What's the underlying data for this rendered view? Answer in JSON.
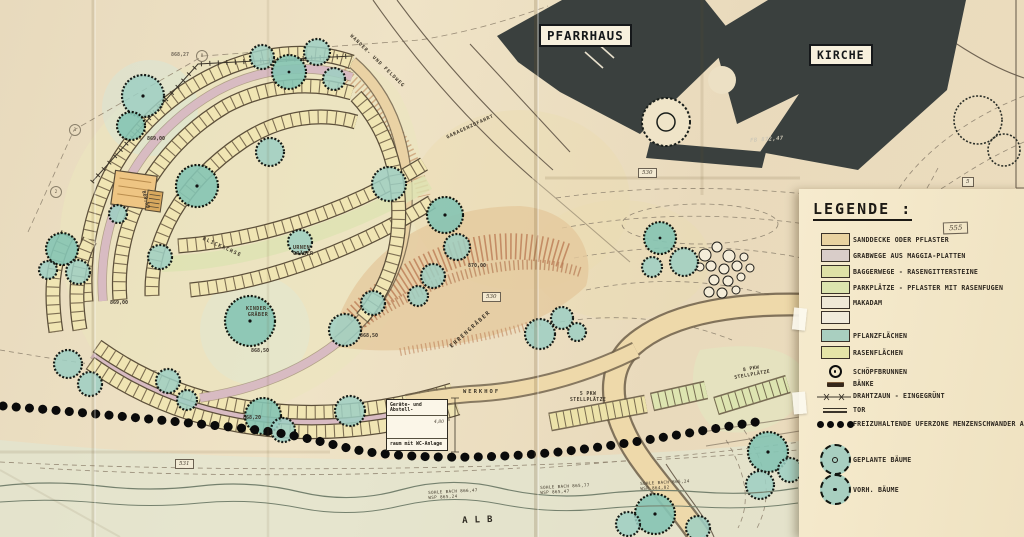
{
  "map": {
    "buildings": {
      "pfarrhaus": "PFARRHAUS",
      "kirche": "KIRCHE",
      "kirche_floor_elevation": "FB 872,47"
    },
    "roads": {
      "wanderweg": "WANDER- UND FELDWEG",
      "garagenzufahrt": "GARAGENZUFAHRT"
    },
    "areas": {
      "blickachse": "BLICKACHSE",
      "urnengraeber_l1": "URNEN-",
      "urnengraeber_l2": "GRÄBER",
      "kindergraeber_l1": "KINDER-",
      "kindergraeber_l2": "GRÄBER",
      "ehrengraeber": "EHRENGRÄBER",
      "werkhof": "WERKHOF",
      "stellplaetze5_l1": "5 PKW",
      "stellplaetze5_l2": "STELLPLÄTZE",
      "stellplaetze8_l1": "8 PKW",
      "stellplaetze8_l2": "STELLPLÄTZE"
    },
    "shed": {
      "line1": "Geräte- und Abstell-",
      "line2": "raum mit WC-Anlage",
      "dim": "4,80"
    },
    "parcels": {
      "p530a": "530",
      "p530b": "530",
      "p531": "531",
      "p5": "5"
    },
    "markers": {
      "m1": "1",
      "m2": "2",
      "m8": "8"
    },
    "elevations": {
      "e1": "869,00",
      "e2": "869,00",
      "e3": "868,50",
      "e4": "868,50",
      "e5": "870,00",
      "e6": "868,20",
      "e7": "868,27",
      "e8": "869,50"
    },
    "river": {
      "name": "ALB",
      "g1": {
        "sohle": "SOHLE BACH",
        "sohle_e": "866,47",
        "wsp": "WSP",
        "wsp_e": "865,24"
      },
      "g2": {
        "sohle": "SOHLE BACH",
        "sohle_e": "865,77",
        "wsp": "WSP",
        "wsp_e": "865,47"
      },
      "g3": {
        "sohle": "SOHLE BACH",
        "sohle_e": "865,24",
        "wsp": "WSP",
        "wsp_e": "864,82"
      }
    }
  },
  "legend": {
    "title": "LEGENDE :",
    "sheet_no": "555",
    "items": [
      {
        "label": "SANDDECKE ODER PFLASTER",
        "color": "#e9d2a0"
      },
      {
        "label": "GRABWEGE AUS MAGGIA-PLATTEN",
        "color": "#d9cdc9"
      },
      {
        "label": "BAGGERWEGE - RASENGITTERSTEINE",
        "color": "#dfe1a6"
      },
      {
        "label": "PARKPLÄTZE - PFLASTER MIT RASENFUGEN",
        "color": "#dce4ae"
      },
      {
        "label": "MAKADAM",
        "color": "#efe8d6"
      },
      {
        "label": "",
        "color": "#f1ebdb"
      },
      {
        "label": "PFLANZFLÄCHEN",
        "color": "#a9cfc0"
      },
      {
        "label": "RASENFLÄCHEN",
        "color": "#e5e4a7"
      }
    ],
    "symbols": [
      {
        "label": "SCHÖPFBRUNNEN"
      },
      {
        "label": "BÄNKE"
      },
      {
        "label": "DRAHTZAUN - EINGEGRÜNT"
      },
      {
        "label": "TOR"
      },
      {
        "label": "FREIZUHALTENDE UFERZONE MENZENSCHWANDER ALB"
      },
      {
        "label": "GEPLANTE BÄUME"
      },
      {
        "label": "VORH. BÄUME"
      }
    ]
  }
}
